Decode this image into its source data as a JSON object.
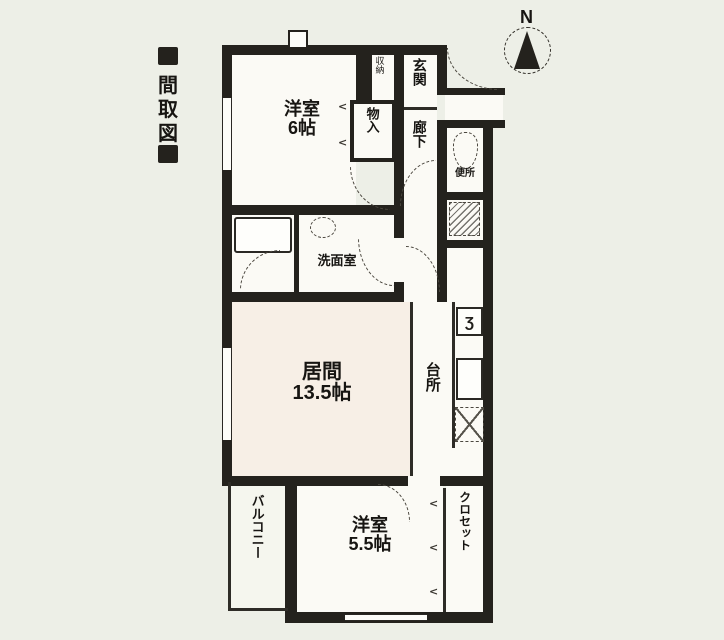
{
  "title_chars": [
    "間",
    "取",
    "図"
  ],
  "compass": {
    "label": "N"
  },
  "rooms": {
    "bedroom1": {
      "name": "洋室",
      "size": "6帖"
    },
    "shoe_storage": {
      "label": "収納"
    },
    "entrance": {
      "label": "玄関"
    },
    "corridor": {
      "label": "廊下"
    },
    "storage": {
      "label": "物入"
    },
    "toilet": {
      "label": "便所"
    },
    "washroom": {
      "label": "洗面室"
    },
    "living": {
      "name": "居間",
      "size": "13.5帖"
    },
    "kitchen": {
      "label": "台所"
    },
    "balcony": {
      "label": "バルコニー"
    },
    "bedroom2": {
      "name": "洋室",
      "size": "5.5帖"
    },
    "closet": {
      "label": "クロセット"
    }
  },
  "icons": {
    "stove_glyph": "Ʒ",
    "fold_chevron": "<"
  },
  "colors": {
    "wall": "#24221d",
    "paper": "#edefe7",
    "room": "#fbfaf5",
    "living_tint": "#f7efe6"
  }
}
